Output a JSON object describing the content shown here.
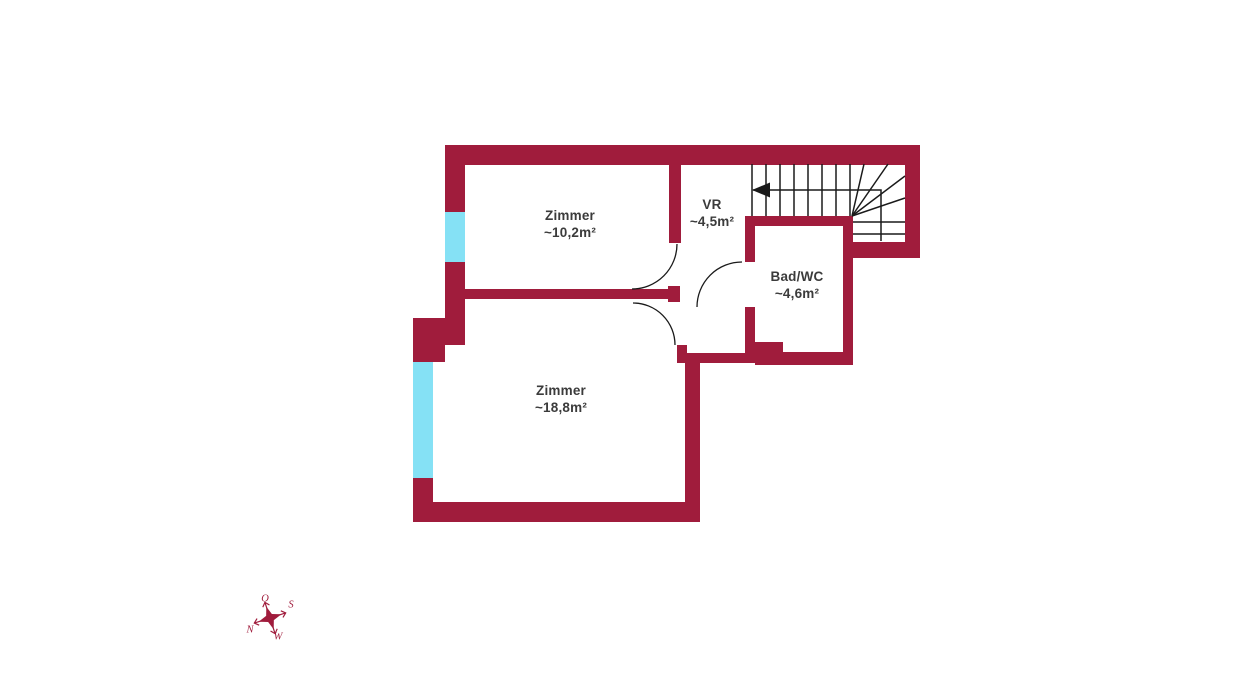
{
  "title": "floor-plan",
  "colors": {
    "wall": "#A01C3C",
    "window": "#85E1F5",
    "line": "#1a1a1a",
    "label_text": "#3b3b3b"
  },
  "rooms": [
    {
      "name": "Zimmer",
      "area": "~10,2m²"
    },
    {
      "name": "VR",
      "area": "~4,5m²"
    },
    {
      "name": "Bad/WC",
      "area": "~4,6m²"
    },
    {
      "name": "Zimmer",
      "area": "~18,8m²"
    }
  ],
  "compass": {
    "north": "N",
    "east": "O",
    "south": "S",
    "west": "W"
  }
}
